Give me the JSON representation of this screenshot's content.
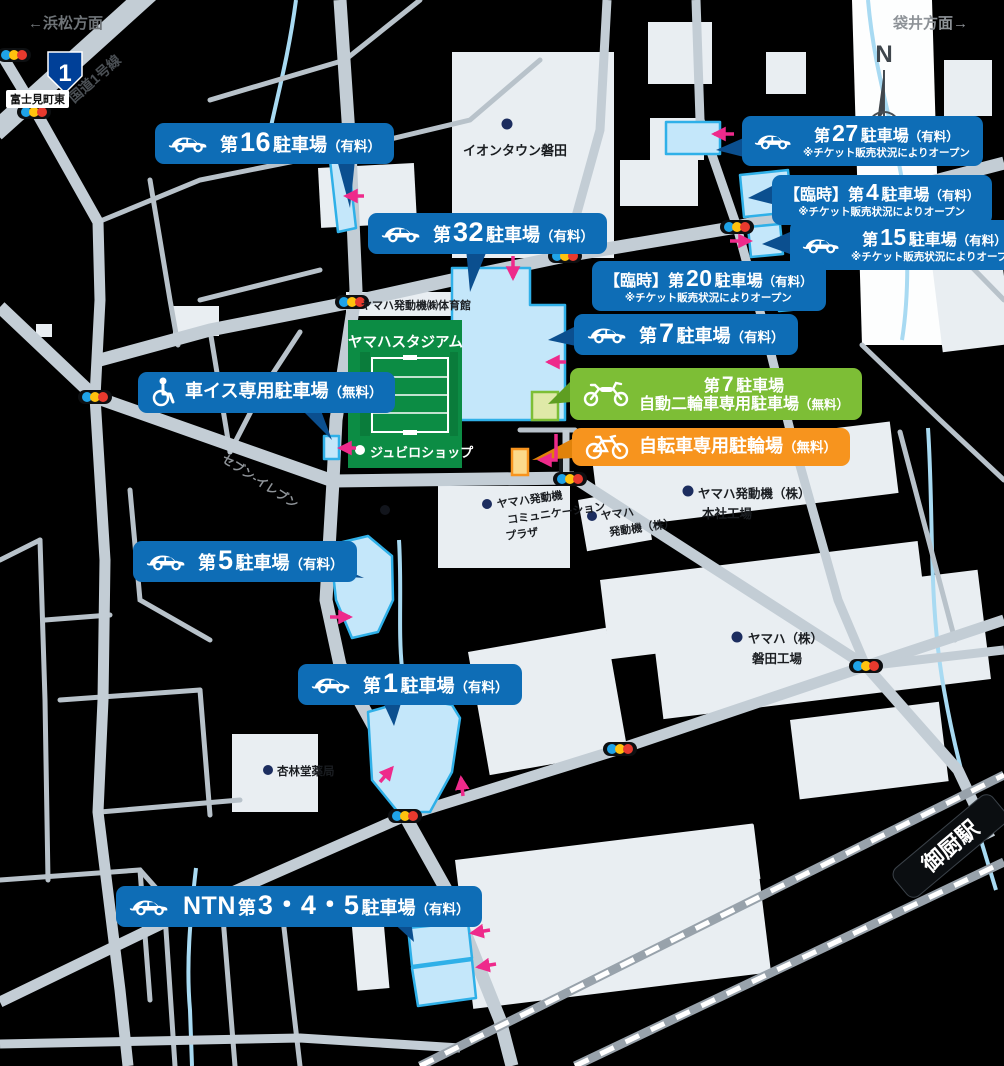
{
  "colors": {
    "plaque_blue": "#0e6db6",
    "plaque_green": "#7dbe36",
    "plaque_orange": "#f7941e",
    "parking_fill": "#c4e7fa",
    "parking_stroke": "#2fb0e8",
    "arrow_pink": "#ee2a8b",
    "road_grey": "#c3cdd5",
    "stadium_green": "#0c8c44"
  },
  "directions": {
    "west": "←浜松方面",
    "east": "袋井方面→"
  },
  "roads": {
    "route_shield": "1",
    "route_name": "国道1号線",
    "intersection": "富士見町東"
  },
  "compass_n": "N",
  "station_name": "御厨駅",
  "places": {
    "aeon": "イオンタウン磐田",
    "gym": "ヤマハ発動機㈱体育館",
    "stadium": "ヤマハスタジアム",
    "shop": "ジュビロショップ",
    "seven_eleven": "セブン-イレブン",
    "plaza_l1": "ヤマハ発動機",
    "plaza_l2": "コミュニケーション",
    "plaza_l3": "プラザ",
    "ymc_l1": "ヤマハ",
    "ymc_l2": "発動機（株）",
    "hq_l1": "ヤマハ発動機（株）",
    "hq_l2": "本社工場",
    "iwata_l1": "ヤマハ（株）",
    "iwata_l2": "磐田工場",
    "pharmacy": "杏林堂薬局"
  },
  "ticket_note": "※チケット販売状況によりオープン",
  "parking": {
    "p16": {
      "pre": "第",
      "num": "16",
      "post": "駐車場",
      "fee": "（有料）"
    },
    "p32": {
      "pre": "第",
      "num": "32",
      "post": "駐車場",
      "fee": "（有料）"
    },
    "p27": {
      "pre": "第",
      "num": "27",
      "post": "駐車場",
      "fee": "（有料）"
    },
    "p4": {
      "pre": "【臨時】第",
      "num": "4",
      "post": "駐車場",
      "fee": "（有料）"
    },
    "p15": {
      "pre": "第",
      "num": "15",
      "post": "駐車場",
      "fee": "（有料）"
    },
    "p20": {
      "pre": "【臨時】第",
      "num": "20",
      "post": "駐車場",
      "fee": "（有料）"
    },
    "p7": {
      "pre": "第",
      "num": "7",
      "post": "駐車場",
      "fee": "（有料）"
    },
    "moto": {
      "l1pre": "第",
      "l1num": "7",
      "l1post": "駐車場",
      "line2": "自動二輪車専用駐車場",
      "fee": "（無料）"
    },
    "bike": {
      "title": "自転車専用駐輪場",
      "fee": "（無料）"
    },
    "wheelchair": {
      "title": "車イス専用駐車場",
      "fee": "（無料）"
    },
    "p5": {
      "pre": "第",
      "num": "5",
      "post": "駐車場",
      "fee": "（有料）"
    },
    "p1": {
      "pre": "第",
      "num": "1",
      "post": "駐車場",
      "fee": "（有料）"
    },
    "ntn": {
      "brand": "NTN",
      "pre": "第",
      "num": "3・4・5",
      "post": "駐車場",
      "fee": "（有料）"
    }
  }
}
